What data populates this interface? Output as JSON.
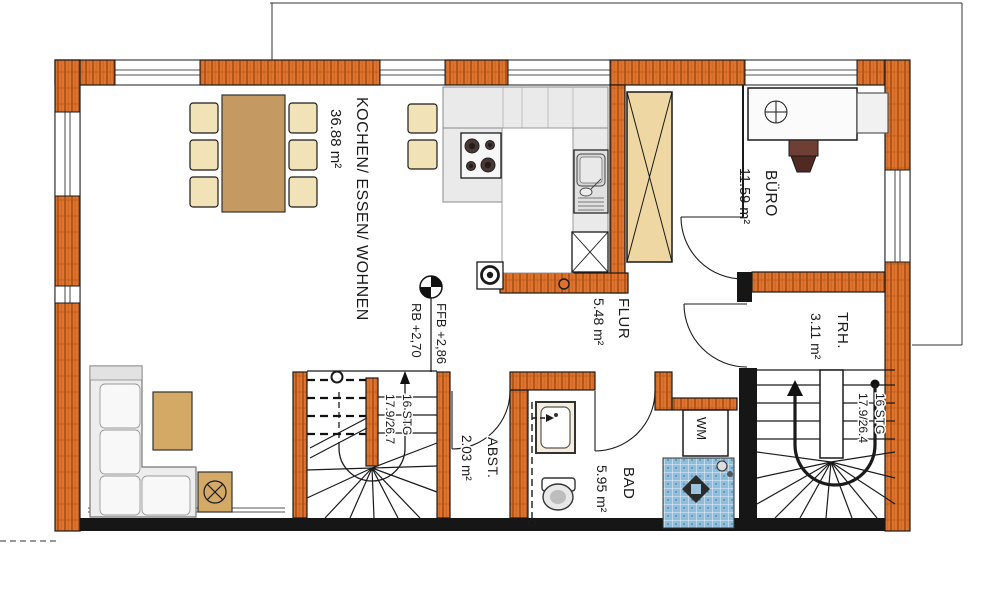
{
  "plan": {
    "rooms": [
      {
        "name": "KOCHEN/ ESSEN/ WOHNEN",
        "area": "36.88 m²"
      },
      {
        "name": "BÜRO",
        "area": "11.59 m²"
      },
      {
        "name": "FLUR",
        "area": "5.48 m²"
      },
      {
        "name": "TRH.",
        "area": "3.11 m²"
      },
      {
        "name": "ABST.",
        "area": "2.03 m²"
      },
      {
        "name": "BAD",
        "area": "5.95 m²"
      }
    ],
    "stairs": [
      {
        "steps": "16 STG",
        "dims": "17.9/26.7"
      },
      {
        "steps": "16 STG",
        "dims": "17.9/26.4"
      }
    ],
    "levels": {
      "ffb": "FFB +2,86",
      "rb": "RB +2,70"
    },
    "appliances": {
      "washing_machine": "WM"
    },
    "colors": {
      "wall_orange": "#DF7430",
      "wall_hatch": "#A0490E",
      "wall_dark": "#161616",
      "wood_cabinet": "#EFD7A4",
      "wood_table": "#C49A62",
      "wood_small_table": "#D3A965",
      "chair_tan": "#F2E2B8",
      "counter_grey": "#EAEAEA",
      "shower_tile_blue": "#8FBEDC",
      "line": "#1a1a1a"
    }
  }
}
